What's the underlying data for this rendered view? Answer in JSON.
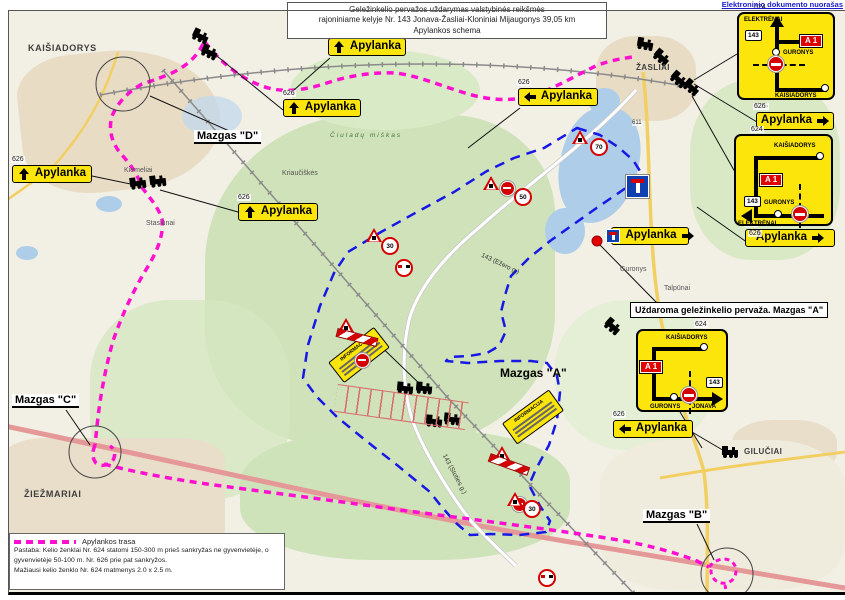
{
  "watermark": "Elektroninio dokumento nuorašas",
  "title": {
    "line1": "Geležinkelio pervažos uždarymas valstybinės reikšmės",
    "line2": "rajoniniame kelyje Nr. 143 Jonava-Žasliai-Kloniniai Mijaugonys 39,05 km",
    "line3": "Apylankos schema"
  },
  "colors": {
    "detour_route": "#FF10D0",
    "closed_area_outline": "#1818E6",
    "sign_yellow": "#FCE50B",
    "sign_red": "#D40000",
    "badge_red": "#E00000",
    "highway_red": "#E59898",
    "road_yellow": "#F2CF63",
    "railway_gray": "#8A8A8A"
  },
  "closure_label": "Uždaroma geležinkelio pervaža. Mazgas \"A\"",
  "nodes": {
    "a_map": "Mazgas \"A\"",
    "b": "Mazgas \"B\"",
    "c": "Mazgas \"C\"",
    "d": "Mazgas \"D\""
  },
  "legend": {
    "route_label": "Apylankos trasa",
    "note1": "Pastaba: Kelio ženklai Nr. 624 statomi 150-300 m prieš sankryžas ne gyvenvietėje, o",
    "note2": "gyvenvietėje 50-100 m. Nr. 626 prie pat sankryžos.",
    "note3": "Mažiausi kelio ženklo Nr. 624 matmenys 2.0 x 2.5 m."
  },
  "detour_signs": [
    {
      "code": "626",
      "arrow": "up",
      "label": "Apylanka",
      "x": 328,
      "y": 38,
      "w": 78
    },
    {
      "code": "626",
      "arrow": "up",
      "label": "Apylanka",
      "x": 283,
      "y": 99,
      "w": 78
    },
    {
      "code": "626",
      "arrow": "up",
      "label": "Apylanka",
      "x": 12,
      "y": 165,
      "w": 80
    },
    {
      "code": "626",
      "arrow": "up",
      "label": "Apylanka",
      "x": 238,
      "y": 203,
      "w": 80
    },
    {
      "code": "626",
      "arrow": "left",
      "label": "Apylanka",
      "x": 518,
      "y": 88,
      "w": 80
    },
    {
      "code": "626",
      "arrow": "right",
      "label": "Apylanka",
      "x": 756,
      "y": 112,
      "w": 78
    },
    {
      "code": "626",
      "arrow": "right",
      "label": "Apylanka",
      "x": 745,
      "y": 229,
      "w": 90
    },
    {
      "icon": "no-through",
      "arrow": "right",
      "label": "Apylanka",
      "x": 611,
      "y": 227,
      "w": 78
    },
    {
      "code": "626",
      "arrow": "left",
      "label": "Apylanka",
      "x": 613,
      "y": 420,
      "w": 80
    }
  ],
  "junctions": {
    "j1": {
      "code_above": "624",
      "code_below": "626",
      "badge": "A 1",
      "shield": "143",
      "top_label": "ELEKTRĖNAI",
      "mid_label": "GURONYS",
      "bottom_label": "KAIŠIADORYS"
    },
    "j2": {
      "code_above": "624",
      "code_below": "626",
      "badge": "A 1",
      "shield": "143",
      "top_label": "KAIŠIADORYS",
      "mid_label": "GURONYS",
      "bottom_label": "ELEKTRĖNAI"
    },
    "j3": {
      "code_above": "624",
      "badge": "A 1",
      "shield": "143",
      "top_label": "KAIŠIADORYS",
      "mid_label": "GURONYS",
      "bottom_label": "JONAVA"
    }
  },
  "map_labels": [
    {
      "text": "KAIŠIADORYS",
      "x": 28,
      "y": 43,
      "cls": "city"
    },
    {
      "text": "ŽASLIAI",
      "x": 636,
      "y": 63,
      "cls": "citysm"
    },
    {
      "text": "ŽIEŽMARIAI",
      "x": 24,
      "y": 489,
      "cls": "city"
    },
    {
      "text": "GILUČIAI",
      "x": 744,
      "y": 447,
      "cls": "citysm"
    },
    {
      "text": "Guronys",
      "x": 620,
      "y": 266,
      "cls": "town"
    },
    {
      "text": "Talpūnai",
      "x": 664,
      "y": 285,
      "cls": "town"
    },
    {
      "text": "Stasiūnai",
      "x": 146,
      "y": 220,
      "cls": "town"
    },
    {
      "text": "Kriaučiškės",
      "x": 282,
      "y": 170,
      "cls": "town"
    },
    {
      "text": "Kiemeliai",
      "x": 124,
      "y": 167,
      "cls": "town"
    },
    {
      "text": "Čiuladų miškas",
      "x": 330,
      "y": 132,
      "cls": "forestlbl"
    }
  ],
  "road_labels": [
    {
      "text": "143 (Ežero g.)",
      "x": 483,
      "y": 252,
      "rot": 25
    },
    {
      "text": "143 (Stoties g.)",
      "x": 447,
      "y": 453,
      "rot": 62
    }
  ],
  "boards": [
    {
      "title": "INFORMACIJA",
      "x": 330,
      "y": 342,
      "rot": -38
    },
    {
      "title": "INFORMACIJA",
      "x": 504,
      "y": 404,
      "rot": -36
    }
  ],
  "sign_clusters": [
    {
      "x": 572,
      "y": 128,
      "items": [
        {
          "t": "tri",
          "dx": 0,
          "dy": 2
        },
        {
          "t": "num",
          "v": "70",
          "dx": 18,
          "dy": 10
        }
      ]
    },
    {
      "x": 483,
      "y": 176,
      "items": [
        {
          "t": "tri",
          "dx": 0,
          "dy": 0
        },
        {
          "t": "noent",
          "dx": 17,
          "dy": 5
        },
        {
          "t": "num",
          "v": "50",
          "dx": 31,
          "dy": 12
        }
      ]
    },
    {
      "x": 366,
      "y": 228,
      "items": [
        {
          "t": "tri",
          "dx": 0,
          "dy": 0
        },
        {
          "t": "num",
          "v": "30",
          "dx": 15,
          "dy": 9
        },
        {
          "t": "noovr",
          "dx": 29,
          "dy": 16
        }
      ]
    },
    {
      "x": 336,
      "y": 318,
      "items": [
        {
          "t": "tri",
          "dx": 2,
          "dy": 0
        },
        {
          "t": "noent",
          "dx": 19,
          "dy": 2
        },
        {
          "t": "bar",
          "dx": 0,
          "dy": 15,
          "rot": 14
        }
      ]
    },
    {
      "x": 494,
      "y": 446,
      "items": [
        {
          "t": "tri",
          "dx": 0,
          "dy": 0
        },
        {
          "t": "noent",
          "dx": 18,
          "dy": 3
        },
        {
          "t": "bar",
          "dx": -6,
          "dy": 14,
          "rot": 20
        }
      ]
    },
    {
      "x": 507,
      "y": 492,
      "items": [
        {
          "t": "tri",
          "dx": 0,
          "dy": 0
        },
        {
          "t": "num",
          "v": "30",
          "dx": 16,
          "dy": 8
        },
        {
          "t": "noovr",
          "dx": 31,
          "dy": 14
        }
      ]
    },
    {
      "x": 626,
      "y": 94,
      "items": [
        {
          "t": "deadend",
          "dx": 0,
          "dy": 0
        },
        {
          "t": "text",
          "v": "611",
          "dx": 6,
          "dy": 26
        }
      ]
    }
  ],
  "trains": [
    {
      "x": 200,
      "y": 37,
      "r": 25
    },
    {
      "x": 209,
      "y": 53,
      "r": 25
    },
    {
      "x": 138,
      "y": 184,
      "r": -8
    },
    {
      "x": 158,
      "y": 182,
      "r": -8
    },
    {
      "x": 645,
      "y": 45,
      "r": 10
    },
    {
      "x": 661,
      "y": 58,
      "r": 40
    },
    {
      "x": 678,
      "y": 80,
      "r": 40
    },
    {
      "x": 691,
      "y": 88,
      "r": 40
    },
    {
      "x": 612,
      "y": 327,
      "r": 40
    },
    {
      "x": 405,
      "y": 389,
      "r": 5
    },
    {
      "x": 424,
      "y": 389,
      "r": 5
    },
    {
      "x": 434,
      "y": 422,
      "r": 5
    },
    {
      "x": 452,
      "y": 420,
      "r": 5
    },
    {
      "x": 730,
      "y": 453,
      "r": 0
    }
  ]
}
